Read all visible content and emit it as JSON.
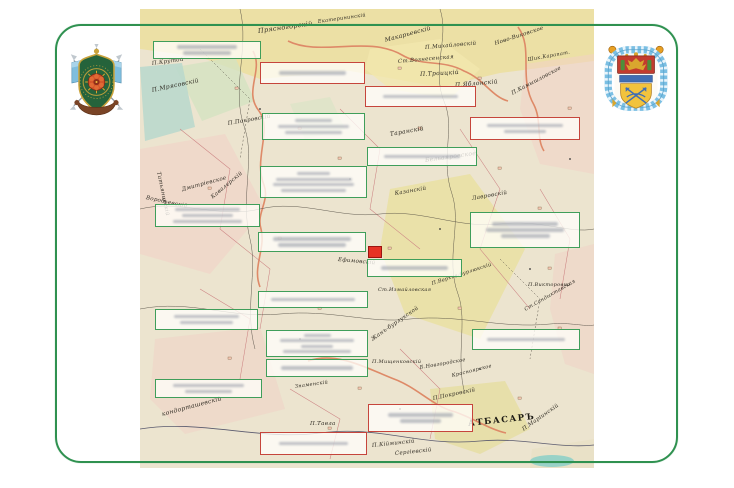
{
  "page": {
    "description": "Genealogy chart of blurred name plaques overlaid on an old Russian-empire map, framed by a green rounded border with two Cossack coats of arms",
    "frame_color": "#2f9150",
    "background_color": "#ffffff"
  },
  "colors": {
    "green_box_border": "#3f9e5a",
    "red_box_border": "#c6453c",
    "red_marker": "#e63225",
    "map_parchment": "#ece4cf",
    "map_yellow": "#ecdf9e",
    "map_pink": "#f2d2c6",
    "map_teal": "#b9d8cc"
  },
  "emblems": {
    "left": {
      "name": "green-shield-cossack-crest"
    },
    "right": {
      "name": "blue-cartouche-cossack-crest"
    }
  },
  "marker": {
    "x": 368,
    "y": 246,
    "w": 14,
    "h": 12
  },
  "overlay_boxes": [
    {
      "id": "g1",
      "color": "green",
      "x": 153,
      "y": 41,
      "w": 108,
      "h": 18,
      "lines": [
        0.62,
        0.5
      ]
    },
    {
      "id": "r1",
      "color": "red",
      "x": 260,
      "y": 62,
      "w": 105,
      "h": 22,
      "lines": [
        0.72
      ]
    },
    {
      "id": "r2",
      "color": "red",
      "x": 365,
      "y": 86,
      "w": 111,
      "h": 21,
      "lines": [
        0.75
      ]
    },
    {
      "id": "g2",
      "color": "green",
      "x": 262,
      "y": 113,
      "w": 103,
      "h": 27,
      "lines": [
        0.4,
        0.78,
        0.62
      ]
    },
    {
      "id": "r3",
      "color": "red",
      "x": 470,
      "y": 117,
      "w": 110,
      "h": 23,
      "lines": [
        0.78,
        0.42
      ]
    },
    {
      "id": "g3",
      "color": "green",
      "x": 367,
      "y": 147,
      "w": 110,
      "h": 19,
      "lines": [
        0.78
      ]
    },
    {
      "id": "g4",
      "color": "green",
      "x": 260,
      "y": 166,
      "w": 107,
      "h": 32,
      "lines": [
        0.35,
        0.8,
        0.85,
        0.68
      ]
    },
    {
      "id": "g5",
      "color": "green",
      "x": 155,
      "y": 204,
      "w": 105,
      "h": 23,
      "lines": [
        0.7,
        0.55,
        0.75
      ]
    },
    {
      "id": "g6",
      "color": "green",
      "x": 470,
      "y": 212,
      "w": 110,
      "h": 36,
      "lines": [
        0.68,
        0.8,
        0.5
      ]
    },
    {
      "id": "g7",
      "color": "green",
      "x": 258,
      "y": 232,
      "w": 108,
      "h": 20,
      "lines": [
        0.82,
        0.7
      ]
    },
    {
      "id": "g8",
      "color": "green",
      "x": 367,
      "y": 259,
      "w": 95,
      "h": 18,
      "lines": [
        0.8
      ]
    },
    {
      "id": "g9",
      "color": "green",
      "x": 258,
      "y": 291,
      "w": 110,
      "h": 17,
      "lines": [
        0.85
      ]
    },
    {
      "id": "g10",
      "color": "green",
      "x": 155,
      "y": 309,
      "w": 103,
      "h": 21,
      "lines": [
        0.72,
        0.58
      ]
    },
    {
      "id": "g11",
      "color": "green",
      "x": 472,
      "y": 329,
      "w": 108,
      "h": 21,
      "lines": [
        0.82
      ]
    },
    {
      "id": "g12",
      "color": "green",
      "x": 266,
      "y": 330,
      "w": 102,
      "h": 27,
      "lines": [
        0.3,
        0.82,
        0.35,
        0.75
      ]
    },
    {
      "id": "g13",
      "color": "green",
      "x": 266,
      "y": 359,
      "w": 102,
      "h": 18,
      "lines": [
        0.8
      ]
    },
    {
      "id": "g14",
      "color": "green",
      "x": 155,
      "y": 379,
      "w": 107,
      "h": 19,
      "lines": [
        0.75,
        0.5
      ]
    },
    {
      "id": "r5",
      "color": "red",
      "x": 368,
      "y": 404,
      "w": 105,
      "h": 28,
      "lines": [
        0.7,
        0.45
      ]
    },
    {
      "id": "r4",
      "color": "red",
      "x": 260,
      "y": 432,
      "w": 107,
      "h": 23,
      "lines": [
        0.72
      ]
    }
  ],
  "map": {
    "labels": [
      {
        "text": "АТБАСАРЪ",
        "x": 328,
        "y": 410,
        "rot": -6,
        "size": 8.5,
        "city": true
      },
      {
        "text": "П.Марiинскій",
        "x": 383,
        "y": 418,
        "rot": -35,
        "size": 5.5
      },
      {
        "text": "П.Михайловскій",
        "x": 285,
        "y": 36,
        "rot": -5,
        "size": 5.5
      },
      {
        "text": "Ст.Вознесенская",
        "x": 258,
        "y": 50,
        "rot": -5,
        "size": 5.5
      },
      {
        "text": "П.Троицкій",
        "x": 280,
        "y": 62,
        "rot": -3,
        "size": 6
      },
      {
        "text": "П.Яблонскій",
        "x": 315,
        "y": 73,
        "rot": -5,
        "size": 6
      },
      {
        "text": "Ново-Виковское",
        "x": 355,
        "y": 32,
        "rot": -18,
        "size": 5.5
      },
      {
        "text": "Шик.Карапат.",
        "x": 388,
        "y": 48,
        "rot": -10,
        "size": 5
      },
      {
        "text": "П.Камышловское",
        "x": 372,
        "y": 82,
        "rot": -28,
        "size": 5.5
      },
      {
        "text": "Макарьевскій",
        "x": 245,
        "y": 28,
        "rot": -15,
        "size": 6
      },
      {
        "text": "Прясногорскій",
        "x": 118,
        "y": 18,
        "rot": -8,
        "size": 6.5
      },
      {
        "text": "Екатерининскій",
        "x": 178,
        "y": 10,
        "rot": -8,
        "size": 5
      },
      {
        "text": "Таранскій",
        "x": 250,
        "y": 122,
        "rot": -10,
        "size": 6
      },
      {
        "text": "Бельаяровское",
        "x": 285,
        "y": 148,
        "rot": -8,
        "size": 6
      },
      {
        "text": "Татьянинскій",
        "x": 18,
        "y": 160,
        "rot": 78,
        "size": 5.5
      },
      {
        "text": "Воробьевскій",
        "x": 6,
        "y": 186,
        "rot": 12,
        "size": 5.5
      },
      {
        "text": "Дмитріевское",
        "x": 42,
        "y": 178,
        "rot": -15,
        "size": 5.5
      },
      {
        "text": "Кавалерскій",
        "x": 72,
        "y": 186,
        "rot": -40,
        "size": 5.5
      },
      {
        "text": "П.Покровскій",
        "x": 88,
        "y": 112,
        "rot": -10,
        "size": 5.5
      },
      {
        "text": "П.Мрясовскій",
        "x": 12,
        "y": 78,
        "rot": -12,
        "size": 6
      },
      {
        "text": "П.Крутой",
        "x": 12,
        "y": 52,
        "rot": -8,
        "size": 5.5
      },
      {
        "text": "Казанскій",
        "x": 255,
        "y": 182,
        "rot": -10,
        "size": 5.5
      },
      {
        "text": "Лавровскій",
        "x": 332,
        "y": 187,
        "rot": -10,
        "size": 5.5
      },
      {
        "text": "Ефимовскій",
        "x": 198,
        "y": 248,
        "rot": 5,
        "size": 5.5
      },
      {
        "text": "П.Верхне-бурлюкскій",
        "x": 292,
        "y": 272,
        "rot": -18,
        "size": 5
      },
      {
        "text": "Ст.Измайловская",
        "x": 238,
        "y": 278,
        "rot": 0,
        "size": 5
      },
      {
        "text": "П.Викторовка",
        "x": 388,
        "y": 273,
        "rot": 0,
        "size": 5
      },
      {
        "text": "Ст.Сандыктавская",
        "x": 385,
        "y": 298,
        "rot": -30,
        "size": 5
      },
      {
        "text": "Жанъ-бурлукской",
        "x": 232,
        "y": 328,
        "rot": -35,
        "size": 5.5
      },
      {
        "text": "кондорташевскій",
        "x": 22,
        "y": 402,
        "rot": -15,
        "size": 6
      },
      {
        "text": "Знаменскій",
        "x": 155,
        "y": 375,
        "rot": -8,
        "size": 5
      },
      {
        "text": "П.Тавла",
        "x": 170,
        "y": 412,
        "rot": 0,
        "size": 5.5
      },
      {
        "text": "Б.Новгородское",
        "x": 280,
        "y": 356,
        "rot": -10,
        "size": 5
      },
      {
        "text": "Красноярское",
        "x": 312,
        "y": 364,
        "rot": -14,
        "size": 5
      },
      {
        "text": "П.Покровскій",
        "x": 293,
        "y": 387,
        "rot": -12,
        "size": 5.5
      },
      {
        "text": "П.Мищенковскій",
        "x": 232,
        "y": 350,
        "rot": 0,
        "size": 5
      },
      {
        "text": "П.Кійминскій",
        "x": 232,
        "y": 434,
        "rot": -6,
        "size": 5.5
      },
      {
        "text": "Сергіевскій",
        "x": 255,
        "y": 442,
        "rot": -6,
        "size": 5.5
      }
    ]
  }
}
